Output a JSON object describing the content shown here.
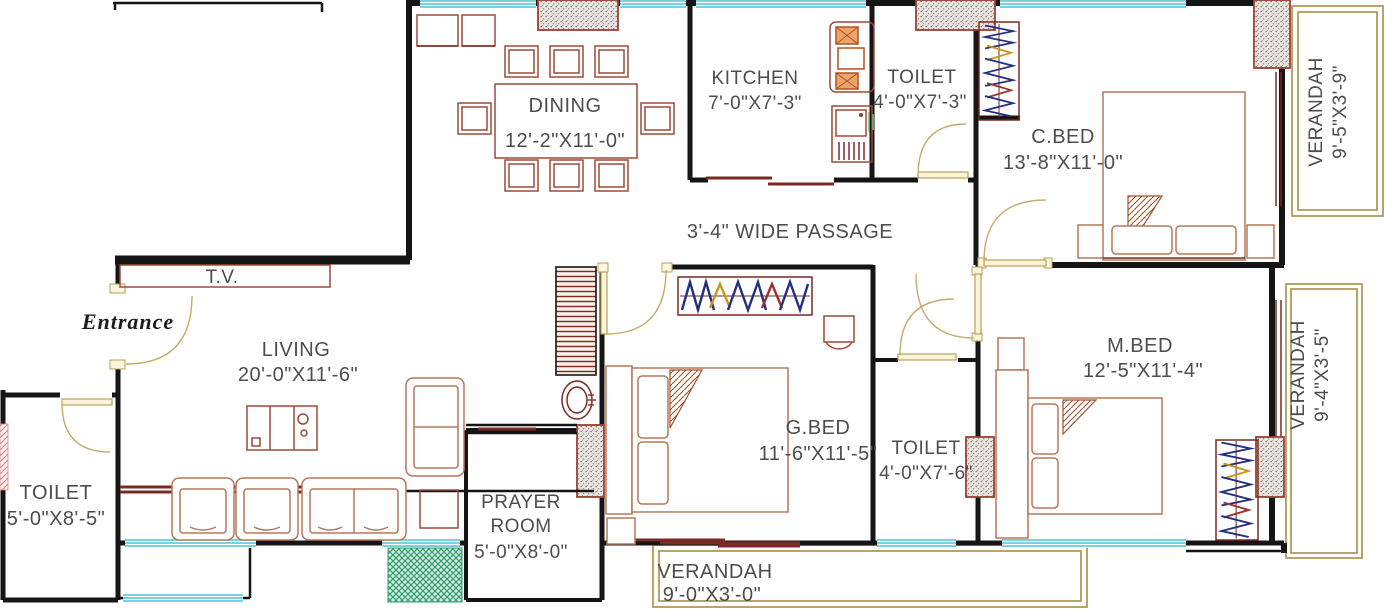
{
  "plan": {
    "rooms": {
      "dining": {
        "label": "DINING",
        "dims": "12'-2\"X11'-0\""
      },
      "kitchen": {
        "label": "KITCHEN",
        "dims": "7'-0\"X7'-3\""
      },
      "toilet_top": {
        "label": "TOILET",
        "dims": "4'-0\"X7'-3\""
      },
      "c_bed": {
        "label": "C.BED",
        "dims": "13'-8\"X11'-0\""
      },
      "verandah_ne": {
        "label": "VERANDAH",
        "dims": "9'-5\"X3'-9\""
      },
      "living": {
        "label": "LIVING",
        "dims": "20'-0\"X11'-6\""
      },
      "toilet_left": {
        "label": "TOILET",
        "dims": "5'-0\"X8'-5\""
      },
      "prayer_room": {
        "label_line1": "PRAYER",
        "label_line2": "ROOM",
        "dims": "5'-0\"X8'-0\""
      },
      "g_bed": {
        "label": "G.BED",
        "dims": "11'-6\"X11'-5\""
      },
      "toilet_mid": {
        "label": "TOILET",
        "dims": "4'-0\"X7'-6\""
      },
      "m_bed": {
        "label": "M.BED",
        "dims": "12'-5\"X11'-4\""
      },
      "verandah_se": {
        "label": "VERANDAH",
        "dims": "9'-4\"X3'-5\""
      },
      "verandah_s": {
        "label": "VERANDAH",
        "dims": "9'-0\"X3'-0\""
      }
    },
    "annotations": {
      "passage": "3'-4\" WIDE PASSAGE",
      "tv": "T.V.",
      "entrance": "Entrance"
    },
    "colors": {
      "wall": "#151515",
      "window": "#4cc4d6",
      "door": "#c2ae6a",
      "furniture": "#9c4a39",
      "furniture_dark": "#7a2a22",
      "verandah_border": "#ad9550",
      "column_border": "#9c3f33",
      "hatch_green": "#2f9e70",
      "hatch_pink": "#d88a8a",
      "zigzag_navy": "#24307e",
      "zigzag_red": "#a03030",
      "zigzag_gold": "#c8961e",
      "text": "#4d4d4d"
    }
  }
}
